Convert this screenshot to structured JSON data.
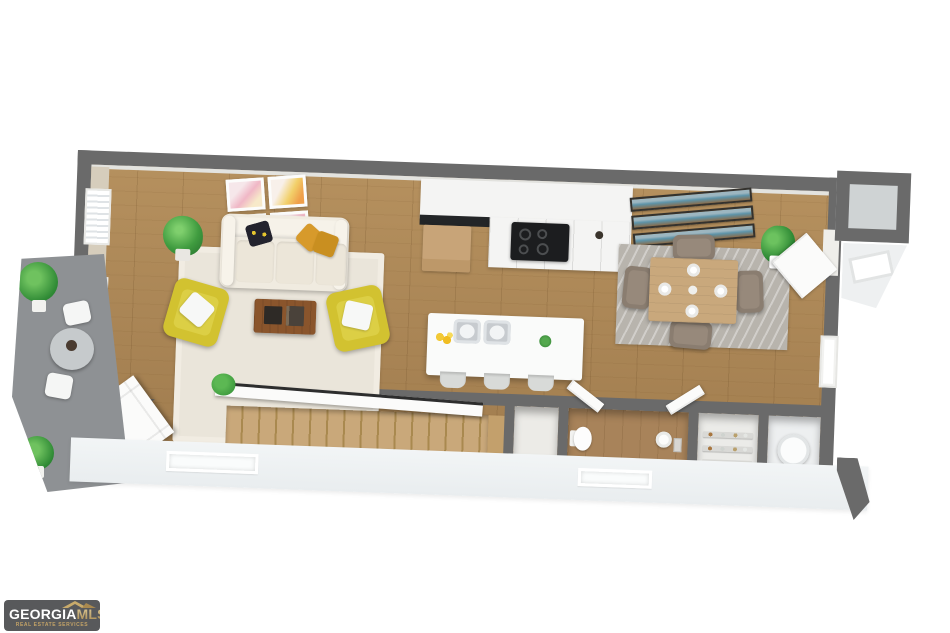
{
  "logo": {
    "brand_primary": "GEORGIA",
    "brand_secondary": "MLS",
    "tagline": "REAL ESTATE SERVICES"
  },
  "colors": {
    "wall_cut": "#6a6a6a",
    "wall_inner": "#e3e3df",
    "wall_beige": "#d6cdbc",
    "porch": "#8e9194",
    "floor_wood": "#b5905e",
    "floor_stair": "#c9a87a",
    "rug_living": "#eae5da",
    "rug_dining": "#b8b4ad",
    "sofa_cream": "#f0ebe0",
    "chair_yellow": "#d2c230",
    "pillow_mustard": "#d79a2b",
    "table_wood": "#8a552c",
    "cabinet_white": "#f4f4f3",
    "counter_black": "#232527",
    "island_white": "#fafbfa",
    "dining_table_wood": "#c9a87c",
    "dining_chair": "#8a7d70",
    "plant_green": "#3f9b3f",
    "door_white": "#fbfbfa",
    "ledge_white": "#f0f3f4",
    "logo_bg": "#58595b",
    "logo_gold": "#c2a267",
    "bath_floor": "#a8835a"
  }
}
